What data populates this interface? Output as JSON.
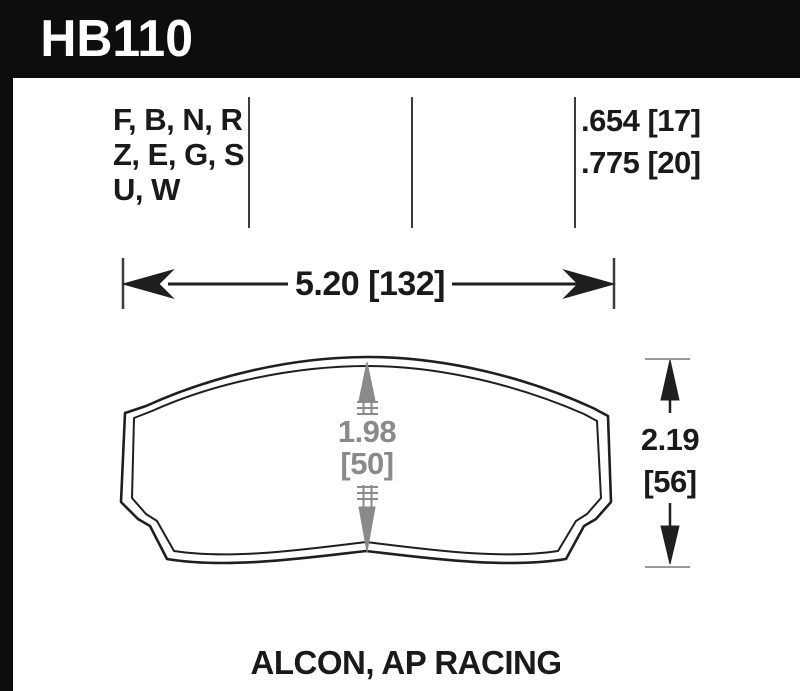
{
  "part": {
    "number": "HB110"
  },
  "compound_table": {
    "compounds": [
      "F, B, N, R",
      "Z, E, G, S",
      "U, W"
    ],
    "thicknesses": [
      ".654 [17]",
      ".775 [20]"
    ]
  },
  "dimensions": {
    "width": "5.20 [132]",
    "center_height_value": "1.98",
    "center_height_metric": "[50]",
    "overall_height_value": "2.19",
    "overall_height_metric": "[56]"
  },
  "footer": {
    "caliper_label": "ALCON, AP RACING"
  },
  "colors": {
    "header_bg": "#0d0d0d",
    "line_color": "#1f1f1f",
    "gray_dim_color": "#8a8a8a",
    "divider_color": "#3b3b3b"
  }
}
